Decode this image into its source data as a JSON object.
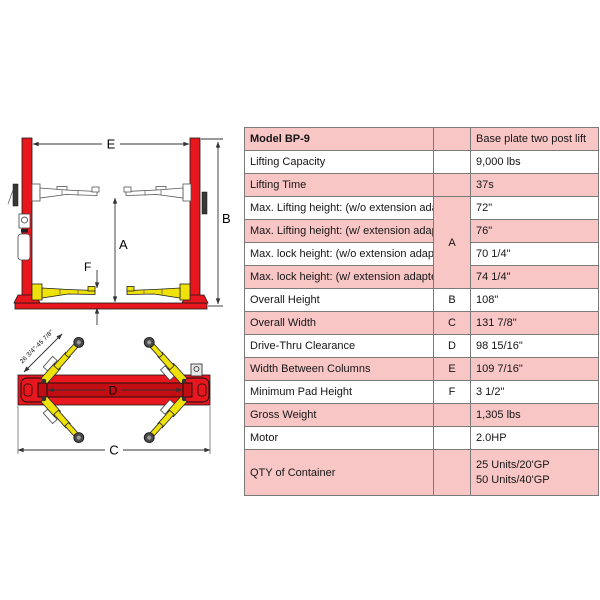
{
  "colors": {
    "row_pink": "#f9c6c6",
    "lift_red": "#e8161d",
    "beam_dark_red": "#c20d13",
    "arm_yellow": "#efe10a"
  },
  "table": {
    "header": {
      "model": "Model BP-9",
      "ref": "",
      "value": "Base plate two post lift"
    },
    "rows": [
      {
        "label": "Lifting Capacity",
        "ref": "",
        "value": "9,000 lbs"
      },
      {
        "label": "Lifting Time",
        "ref": "",
        "value": "37s"
      },
      {
        "label": "Max. Lifting height: (w/o extension adapter)",
        "ref": "A",
        "value": "72\""
      },
      {
        "label": "Max. Lifting height: (w/ extension adapter)",
        "value": "76\""
      },
      {
        "label": "Max. lock height: (w/o extension adapter)",
        "value": "70 1/4\""
      },
      {
        "label": "Max. lock height: (w/ extension adapter)",
        "value": "74 1/4\""
      },
      {
        "label": "Overall Height",
        "ref": "B",
        "value": "108\""
      },
      {
        "label": "Overall Width",
        "ref": "C",
        "value": "131 7/8\""
      },
      {
        "label": "Drive-Thru Clearance",
        "ref": "D",
        "value": "98 15/16\""
      },
      {
        "label": "Width Between Columns",
        "ref": "E",
        "value": "109 7/16\""
      },
      {
        "label": "Minimum Pad Height",
        "ref": "F",
        "value": "3 1/2\""
      },
      {
        "label": "Gross Weight",
        "ref": "",
        "value": "1,305 lbs"
      },
      {
        "label": "Motor",
        "ref": "",
        "value": "2.0HP"
      },
      {
        "label": "QTY of Container",
        "ref": "",
        "value_line1": "25 Units/20'GP",
        "value_line2": "50 Units/40'GP"
      }
    ]
  },
  "diagram": {
    "front_view": {
      "dim_e": "E",
      "dim_b": "B",
      "dim_a": "A",
      "dim_f": "F"
    },
    "top_view": {
      "dim_d": "D",
      "dim_c": "C",
      "arm_range": "26 3/4\"-45 7/8\""
    }
  }
}
